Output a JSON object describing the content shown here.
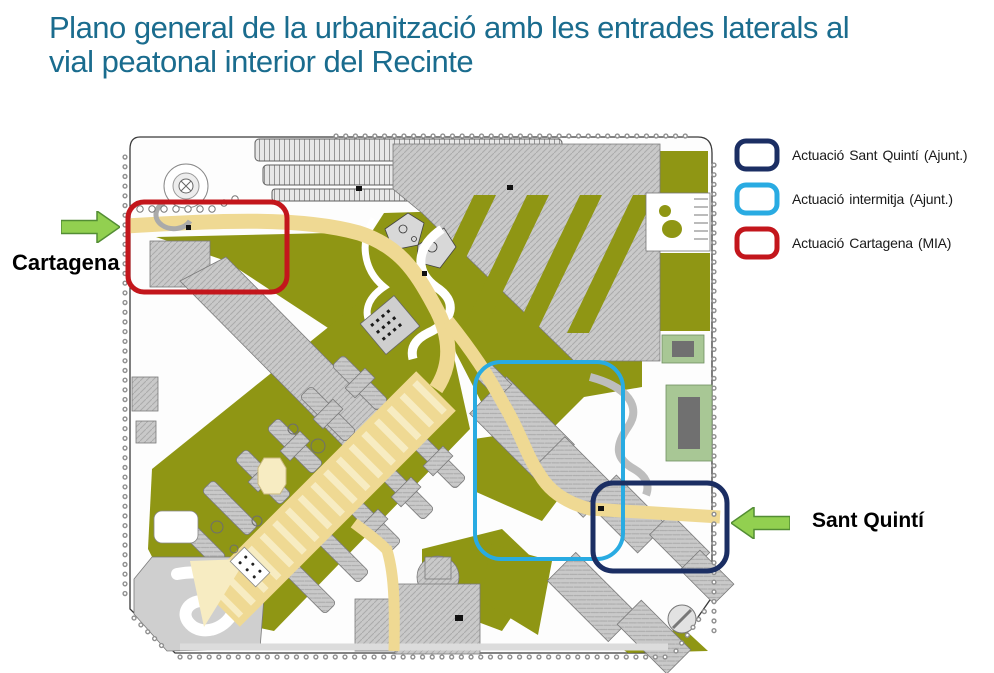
{
  "title": {
    "line1": "Plano general de la urbanització amb les entrades laterals al",
    "line2": "vial peatonal interior del Recinte",
    "color": "#1A6C8E"
  },
  "legend": {
    "items": [
      {
        "label": "Actuació Sant Quintí (Ajunt.)",
        "color": "#1B2E63"
      },
      {
        "label": "Actuació intermitja (Ajunt.)",
        "color": "#29ABE2"
      },
      {
        "label": "Actuació Cartagena (MIA)",
        "color": "#C3161C"
      }
    ]
  },
  "callouts": {
    "arrow_fill": "#92D050",
    "arrow_stroke": "#538D34",
    "left": {
      "label": "Cartagena",
      "direction": "right"
    },
    "right": {
      "label": "Sant Quintí",
      "direction": "left"
    }
  },
  "map": {
    "colors": {
      "green": "#8F9614",
      "path": "#EFD993",
      "path_light": "#F7ECC2",
      "building": "#C9C9C9",
      "parking": "#E7E7E7",
      "outline": "#3A3A3A"
    }
  }
}
